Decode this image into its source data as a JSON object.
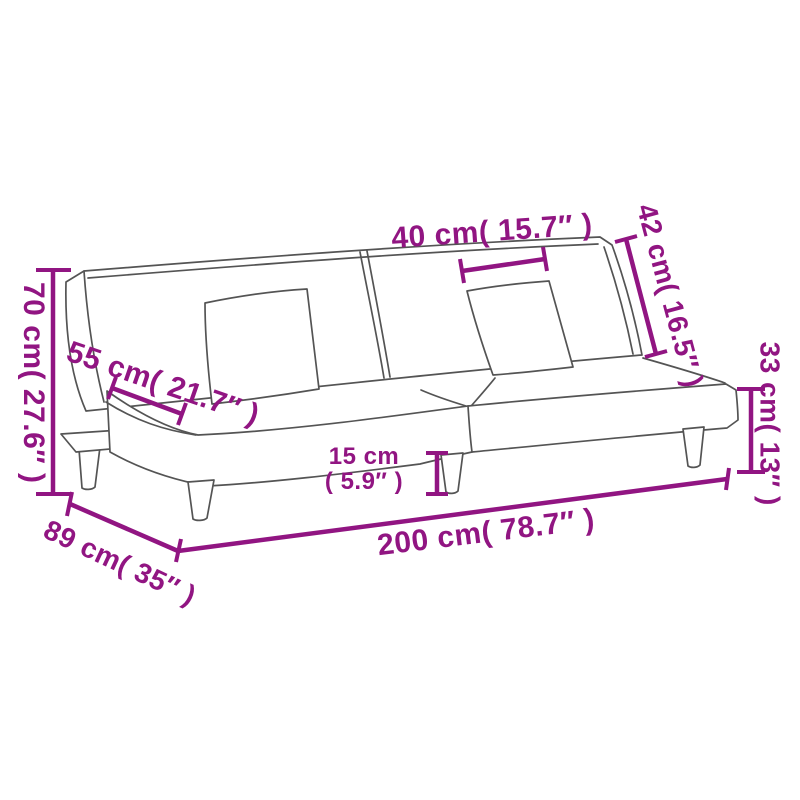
{
  "page": {
    "title": "Sofa bed dimension diagram"
  },
  "colors": {
    "dimension_accent": "#911582",
    "sketch_outline": "#545454",
    "background": "#ffffff"
  },
  "dimensions": {
    "back_height": "70 cm( 27.6″ )",
    "seat_depth": "55 cm( 21.7″ )",
    "back_cushion_width": "40 cm( 15.7″ )",
    "backrest_height": "42 cm( 16.5″ )",
    "seat_height": "33 cm( 13″ )",
    "leg_height_cm": "15 cm",
    "leg_height_inch": "( 5.9″ )",
    "total_depth": "89 cm( 35″ )",
    "total_width": "200 cm( 78.7″ )"
  }
}
